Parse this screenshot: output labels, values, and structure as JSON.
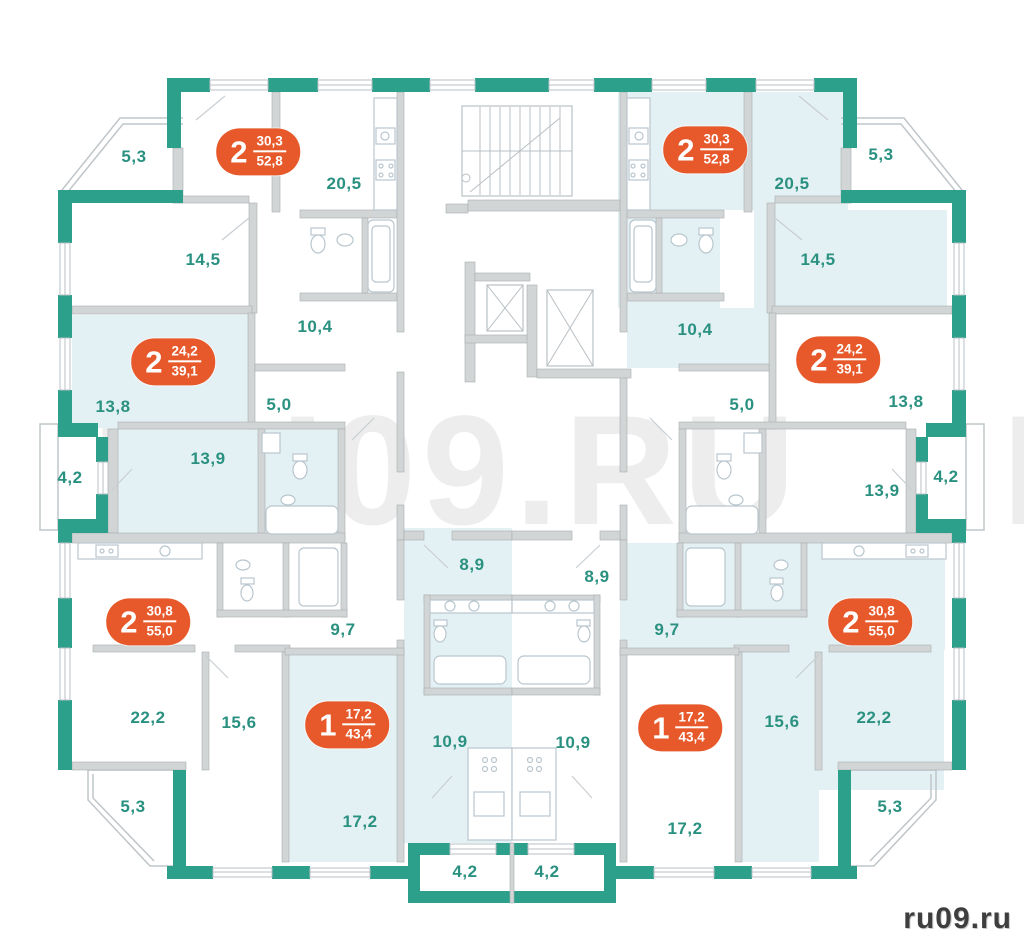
{
  "watermark": {
    "text": "RU09.RU"
  },
  "logo": {
    "text": "ru09.ru"
  },
  "palette": {
    "wall_teal": "#2CA08A",
    "wall_gray": "#D2D5D5",
    "line_gray": "#B9C0C4",
    "room_highlight": "#E4F1F4",
    "label_green": "#2A9181",
    "badge_orange": "#E7592A",
    "badge_text": "#FFFFFF",
    "watermark_gray": "#EDEDED",
    "logo_gray": "#3E3E3E"
  },
  "apartments": [
    {
      "id": "2-room-52-8-left",
      "rooms_count": "2",
      "area_living": "30,3",
      "area_total": "52,8",
      "x": 258,
      "y": 152
    },
    {
      "id": "2-room-52-8-right",
      "rooms_count": "2",
      "area_living": "30,3",
      "area_total": "52,8",
      "x": 705,
      "y": 150
    },
    {
      "id": "2-room-39-1-left",
      "rooms_count": "2",
      "area_living": "24,2",
      "area_total": "39,1",
      "x": 173,
      "y": 362
    },
    {
      "id": "2-room-39-1-right",
      "rooms_count": "2",
      "area_living": "24,2",
      "area_total": "39,1",
      "x": 838,
      "y": 360
    },
    {
      "id": "2-room-55-0-left",
      "rooms_count": "2",
      "area_living": "30,8",
      "area_total": "55,0",
      "x": 148,
      "y": 622
    },
    {
      "id": "2-room-55-0-right",
      "rooms_count": "2",
      "area_living": "30,8",
      "area_total": "55,0",
      "x": 870,
      "y": 622
    },
    {
      "id": "1-room-43-4-left",
      "rooms_count": "1",
      "area_living": "17,2",
      "area_total": "43,4",
      "x": 347,
      "y": 725
    },
    {
      "id": "1-room-43-4-right",
      "rooms_count": "1",
      "area_living": "17,2",
      "area_total": "43,4",
      "x": 680,
      "y": 728
    }
  ],
  "room_labels": [
    {
      "label": "5,3",
      "x": 134,
      "y": 157
    },
    {
      "label": "20,5",
      "x": 344,
      "y": 184
    },
    {
      "label": "14,5",
      "x": 203,
      "y": 260
    },
    {
      "label": "10,4",
      "x": 315,
      "y": 327
    },
    {
      "label": "13,8",
      "x": 113,
      "y": 407
    },
    {
      "label": "5,0",
      "x": 279,
      "y": 405
    },
    {
      "label": "4,2",
      "x": 70,
      "y": 478
    },
    {
      "label": "13,9",
      "x": 208,
      "y": 459
    },
    {
      "label": "8,9",
      "x": 472,
      "y": 565
    },
    {
      "label": "9,7",
      "x": 343,
      "y": 630
    },
    {
      "label": "22,2",
      "x": 148,
      "y": 718
    },
    {
      "label": "15,6",
      "x": 239,
      "y": 723
    },
    {
      "label": "10,9",
      "x": 450,
      "y": 742
    },
    {
      "label": "5,3",
      "x": 133,
      "y": 807
    },
    {
      "label": "17,2",
      "x": 360,
      "y": 822
    },
    {
      "label": "4,2",
      "x": 465,
      "y": 872
    },
    {
      "label": "20,5",
      "x": 792,
      "y": 184
    },
    {
      "label": "5,3",
      "x": 881,
      "y": 155
    },
    {
      "label": "14,5",
      "x": 818,
      "y": 260
    },
    {
      "label": "10,4",
      "x": 695,
      "y": 330
    },
    {
      "label": "5,0",
      "x": 742,
      "y": 405
    },
    {
      "label": "13,8",
      "x": 906,
      "y": 402
    },
    {
      "label": "13,9",
      "x": 882,
      "y": 491
    },
    {
      "label": "4,2",
      "x": 946,
      "y": 477
    },
    {
      "label": "8,9",
      "x": 597,
      "y": 577
    },
    {
      "label": "9,7",
      "x": 667,
      "y": 630
    },
    {
      "label": "22,2",
      "x": 874,
      "y": 718
    },
    {
      "label": "15,6",
      "x": 782,
      "y": 722
    },
    {
      "label": "10,9",
      "x": 573,
      "y": 743
    },
    {
      "label": "17,2",
      "x": 685,
      "y": 829
    },
    {
      "label": "5,3",
      "x": 890,
      "y": 807
    },
    {
      "label": "4,2",
      "x": 547,
      "y": 872
    }
  ]
}
